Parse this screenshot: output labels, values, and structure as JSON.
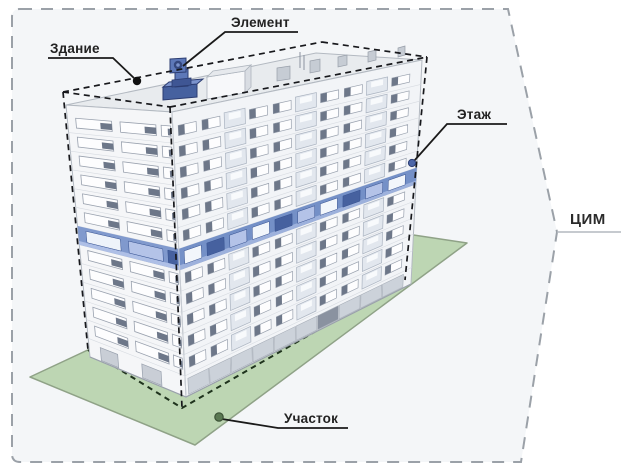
{
  "diagram": {
    "title": "Состав цифровой информационной модели",
    "labels": {
      "building": "Здание",
      "element": "Элемент",
      "floor": "Этаж",
      "site": "Участок",
      "model": "ЦИМ"
    },
    "colors": {
      "background": "#ffffff",
      "model_area_fill": "#f4f6f8",
      "model_border": "#9ba1a8",
      "site_green": "#bdd6b3",
      "site_edge": "#8fa287",
      "footprint_dash": "#1f331d",
      "building_box_dash": "#17181c",
      "facade_left": "#f5f6f8",
      "facade_right": "#f2f4f7",
      "facade_stroke": "#b3b9c1",
      "floor_line": "#d7dbe1",
      "window_stroke": "#99a1ae",
      "window_dark": "#6d7789",
      "balcony_fill": "#e2e7ee",
      "roof": "#e8ebee",
      "rooftop_box": "#c6ccd4",
      "floor_band": "#7490c7",
      "floor_band_left": "#8099cd",
      "floor_band_dark": "#46619f",
      "floor_band_light": "#b4c3e8",
      "floor_band_strip": "#9db1dc",
      "element_blue": "#5d78b8",
      "element_blue_dark": "#2c3d72",
      "element_blue_deep": "#46619f",
      "leader": "#1a1a1a",
      "anchor_building": "#111111",
      "anchor_floor": "#4c66a8",
      "anchor_site": "#5a7852",
      "text": "#222222"
    }
  }
}
